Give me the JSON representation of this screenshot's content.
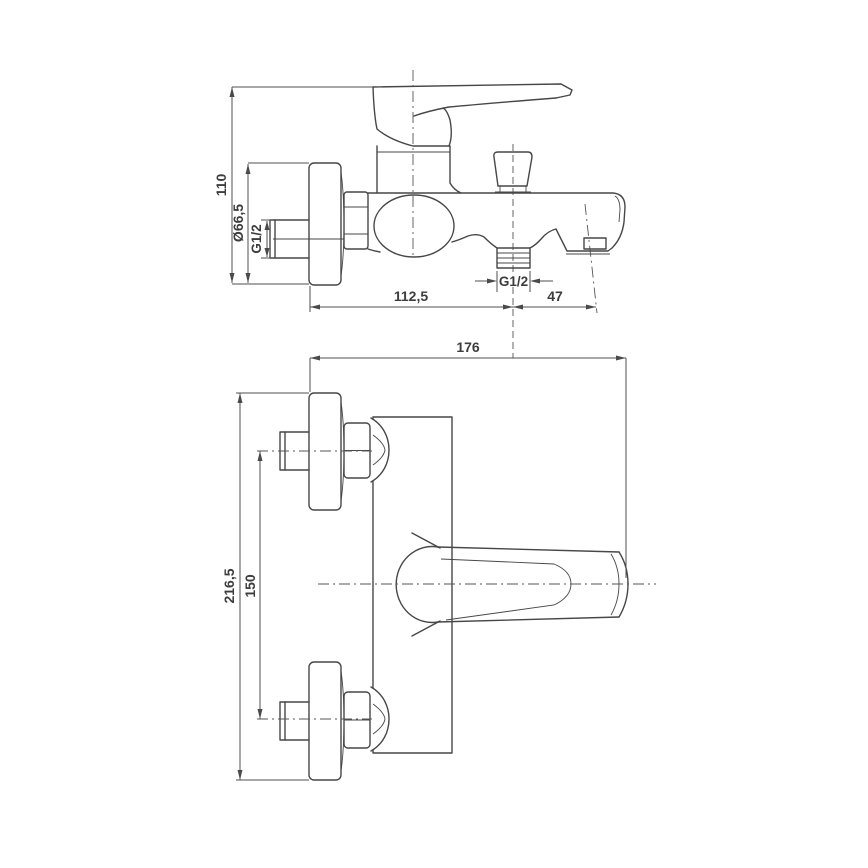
{
  "drawing": {
    "title": "bath-mixer-technical-drawing",
    "background": "#ffffff",
    "line_color": "#474747",
    "text_color": "#3d3d3d",
    "side_view": {
      "dims": {
        "overall_height": "110",
        "flange_diameter": "Ø66,5",
        "inlet_thread": "G1/2",
        "wall_to_shower_outlet": "112,5",
        "shower_outlet_thread": "G1/2",
        "outlet_to_spout_tip": "47"
      }
    },
    "plan_view": {
      "dims": {
        "overall_depth": "176",
        "overall_width": "216,5",
        "connection_centres": "150"
      }
    }
  }
}
